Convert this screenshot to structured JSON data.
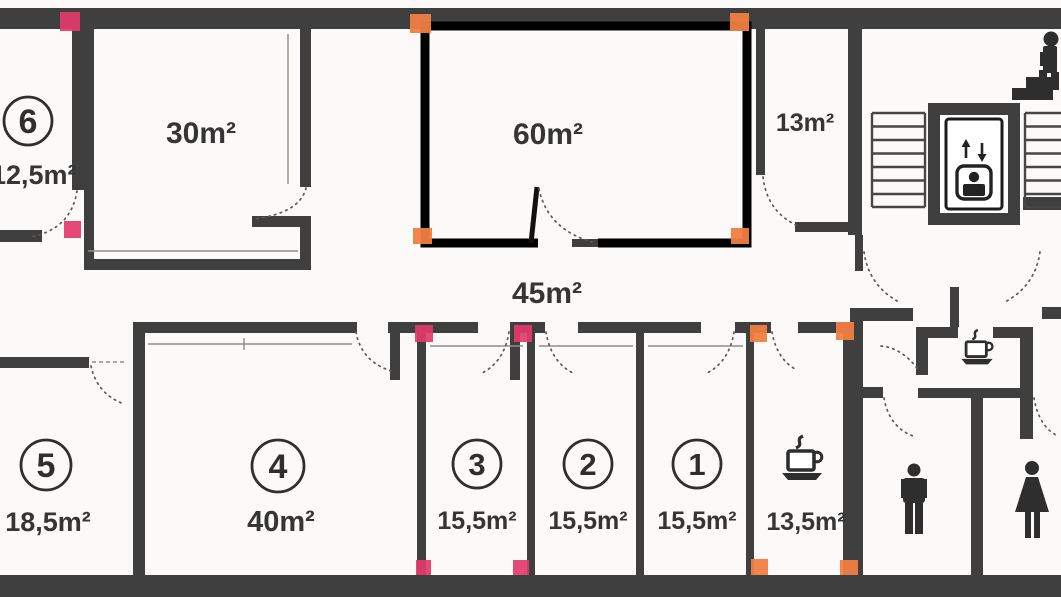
{
  "plan_type": "office-floor-plan-scan",
  "rooms": {
    "room6": {
      "number": "6",
      "area": "12,5m²"
    },
    "room30": {
      "area": "30m²"
    },
    "room60": {
      "area": "60m²"
    },
    "room13": {
      "area": "13m²"
    },
    "corridor": {
      "area": "45m²"
    },
    "room5": {
      "number": "5",
      "area": "18,5m²"
    },
    "room4": {
      "number": "4",
      "area": "40m²"
    },
    "room3": {
      "number": "3",
      "area": "15,5m²"
    },
    "room2": {
      "number": "2",
      "area": "15,5m²"
    },
    "room1": {
      "number": "1",
      "area": "15,5m²"
    },
    "coffee_room": {
      "area": "13,5m²"
    }
  },
  "icons": {
    "coffee_room": "coffee-cup-icon",
    "kitchenette": "coffee-cup-icon",
    "wc_left": "man-icon",
    "wc_right": "woman-icon",
    "elevator": "elevator-icon",
    "top_right": "person-on-stairs-icon",
    "stairwell_left": "staircase-icon",
    "stairwell_right": "staircase-icon"
  },
  "colors": {
    "wall": "#3f3f3f",
    "room60_outline": "#000000",
    "marker_pink": "#e23a6b",
    "marker_orange": "#f07e42",
    "background": "#fbfaf8",
    "text": "#353535"
  },
  "markers": {
    "pink_count": 6,
    "orange_count": 8
  }
}
